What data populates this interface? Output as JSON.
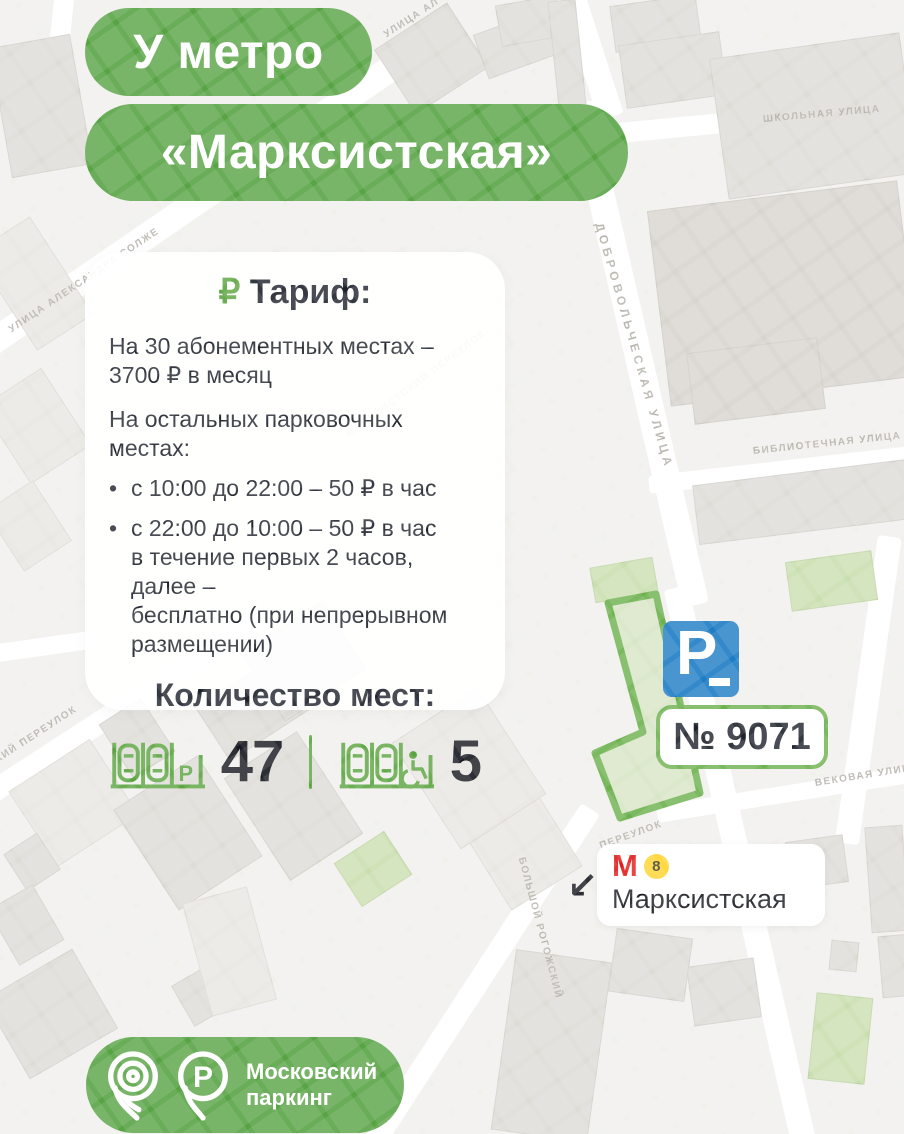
{
  "header": {
    "badge1": "У метро",
    "badge2": "«Марксистская»"
  },
  "card": {
    "tariff_rub_icon": "₽",
    "tariff_title": "Тариф:",
    "line1a": "На 30 абонементных местах –",
    "line1b": "3700 ₽ в месяц",
    "line2": "На остальных парковочных местах:",
    "bullet_mark": "•",
    "bullet1": "с 10:00 до 22:00 – 50 ₽ в час",
    "bullet2a": "с 22:00 до 10:00 – 50 ₽ в час",
    "bullet2b": "в течение первых 2 часов, далее –",
    "bullet2c": "бесплатно (при непрерывном",
    "bullet2d": "размещении)",
    "capacity_title": "Количество мест:",
    "total_spaces": "47",
    "disabled_spaces": "5",
    "stall_icon_letter": "P"
  },
  "map": {
    "parking_number": "№ 9071",
    "parking_sign_letter": "P",
    "metro": {
      "logo_letter": "М",
      "line_number": "8",
      "station": "Марксистская",
      "arrow": "↙"
    },
    "street_labels": [
      "УЛИЦА АЛЕКСАНДРА СОЛЖЕ",
      "УЛИЦА АЛ",
      "ШКОЛЬНАЯ УЛИЦА",
      "ДОБРОВОЛЬЧЕСКАЯ УЛИЦА",
      "БИБЛИОТЕЧНАЯ УЛИЦА",
      "ВЕКОВАЯ УЛИЦА",
      "МАРКСИСТСКИЙ ПЕРЕУЛОК",
      "ТОВАРИЩЕСКИЙ ПЕРЕУЛОК",
      "БОЛЬШОЙ РОГОЖСКИЙ",
      "ПЕРЕУЛОК"
    ]
  },
  "footer": {
    "brand_line1": "Московский",
    "brand_line2": "паркинг",
    "logo_p_letter": "P"
  },
  "colors": {
    "brand_green": "#58a445",
    "zone_stroke": "#6cb14e",
    "sign_blue": "#1d7cc4",
    "metro_red": "#e21a1a",
    "line8_yellow": "#ffd42e",
    "text_dark": "#1d222b"
  }
}
